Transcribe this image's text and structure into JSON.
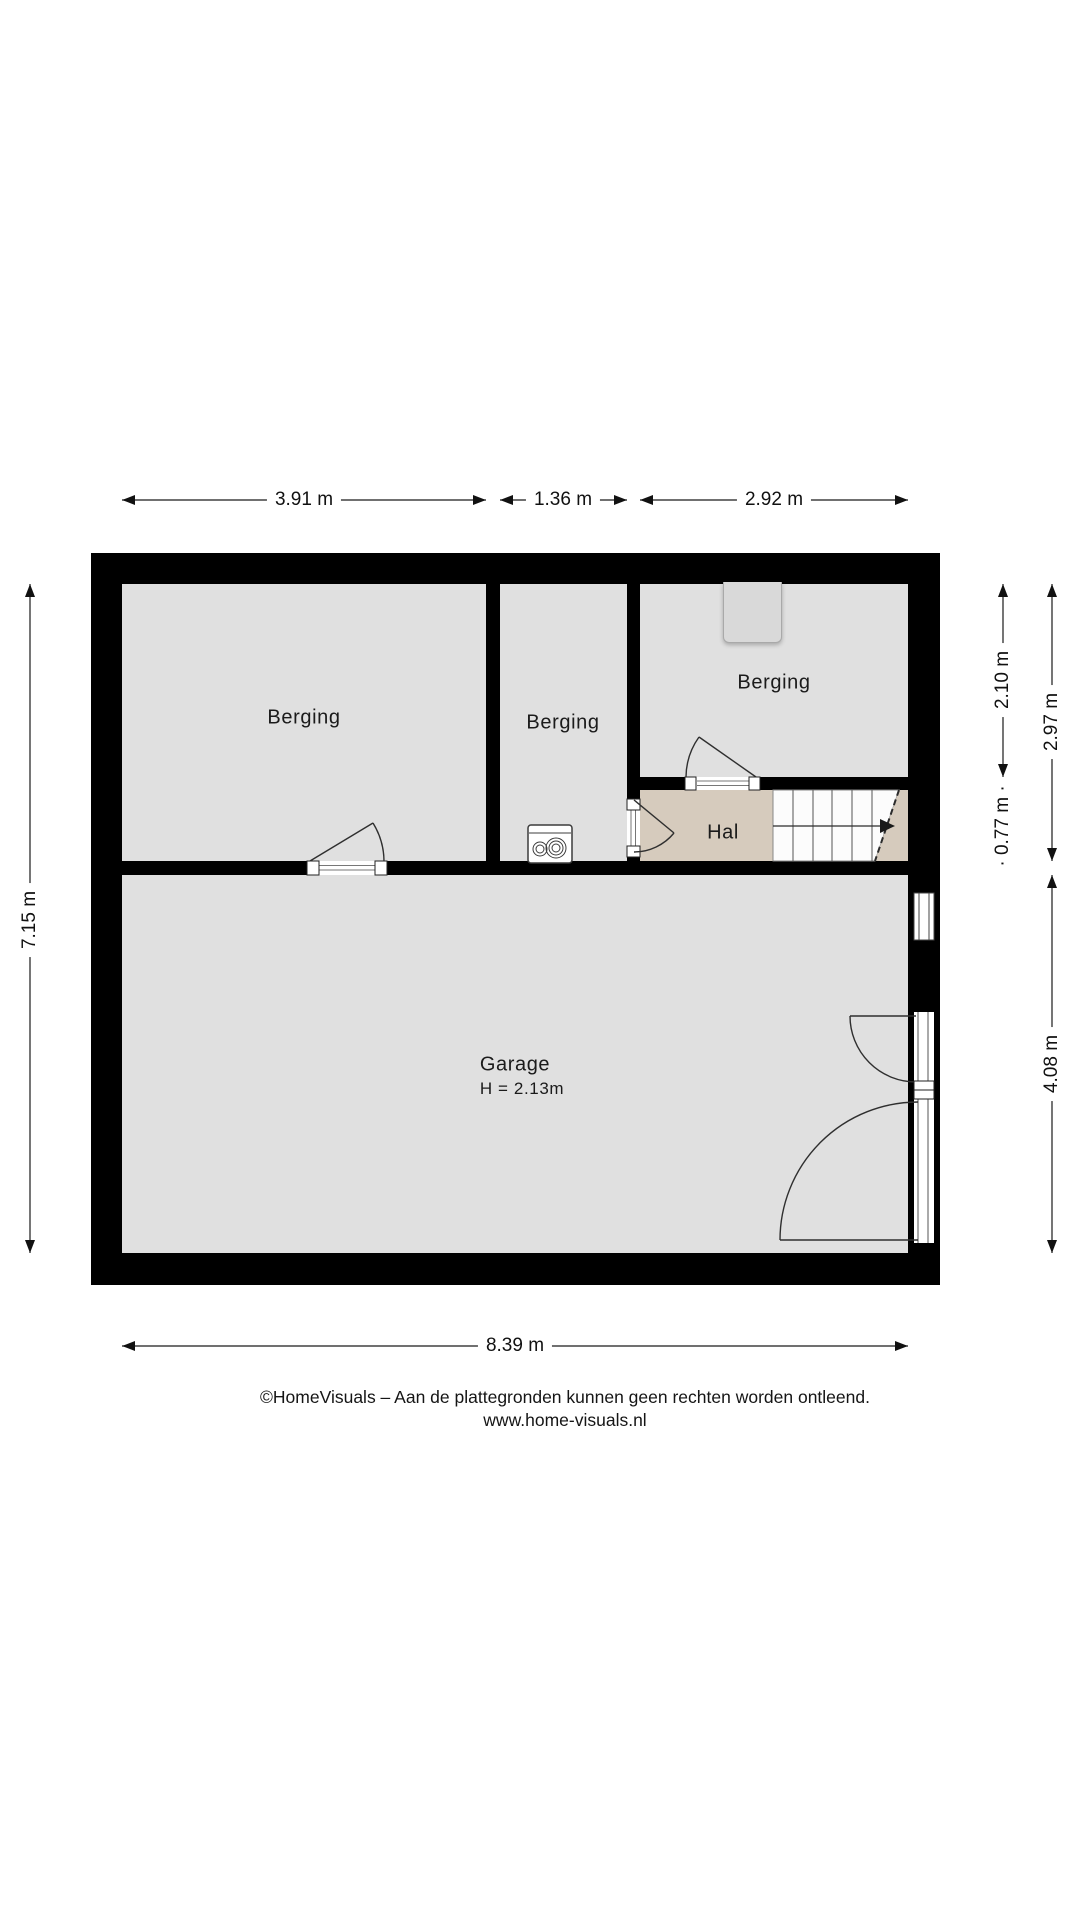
{
  "floorplan": {
    "rooms": {
      "berging_left": {
        "label": "Berging"
      },
      "berging_middle": {
        "label": "Berging"
      },
      "berging_top_right": {
        "label": "Berging"
      },
      "hal": {
        "label": "Hal"
      },
      "garage": {
        "label": "Garage",
        "height_note": "H = 2.13m"
      }
    },
    "dimensions": {
      "top_left_width": "3.91 m",
      "top_middle_width": "1.36 m",
      "top_right_width": "2.92 m",
      "left_total_height": "7.15 m",
      "right_berging_height": "2.10 m",
      "right_berging_hal_height": "2.97 m",
      "right_hal_height": "· 0.77 m ·",
      "right_garage_height": "4.08 m",
      "bottom_total_width": "8.39 m"
    },
    "symbols": {
      "water_heater": "water-heater-icon",
      "staircase": "staircase-up-arrow",
      "doors": "door-swing-arc",
      "window": "window-glazing",
      "garage_door": "double-swing-door",
      "niche": "wall-niche"
    },
    "colors": {
      "wall": "#000000",
      "room_floor": "#e0e0e0",
      "hal_floor": "#d6cbbd",
      "stairs": "#fcfcfc",
      "niche": "#d9d9d9"
    }
  },
  "footer": {
    "line1": "©HomeVisuals – Aan de plattegronden kunnen geen rechten worden ontleend.",
    "line2": "www.home-visuals.nl"
  }
}
